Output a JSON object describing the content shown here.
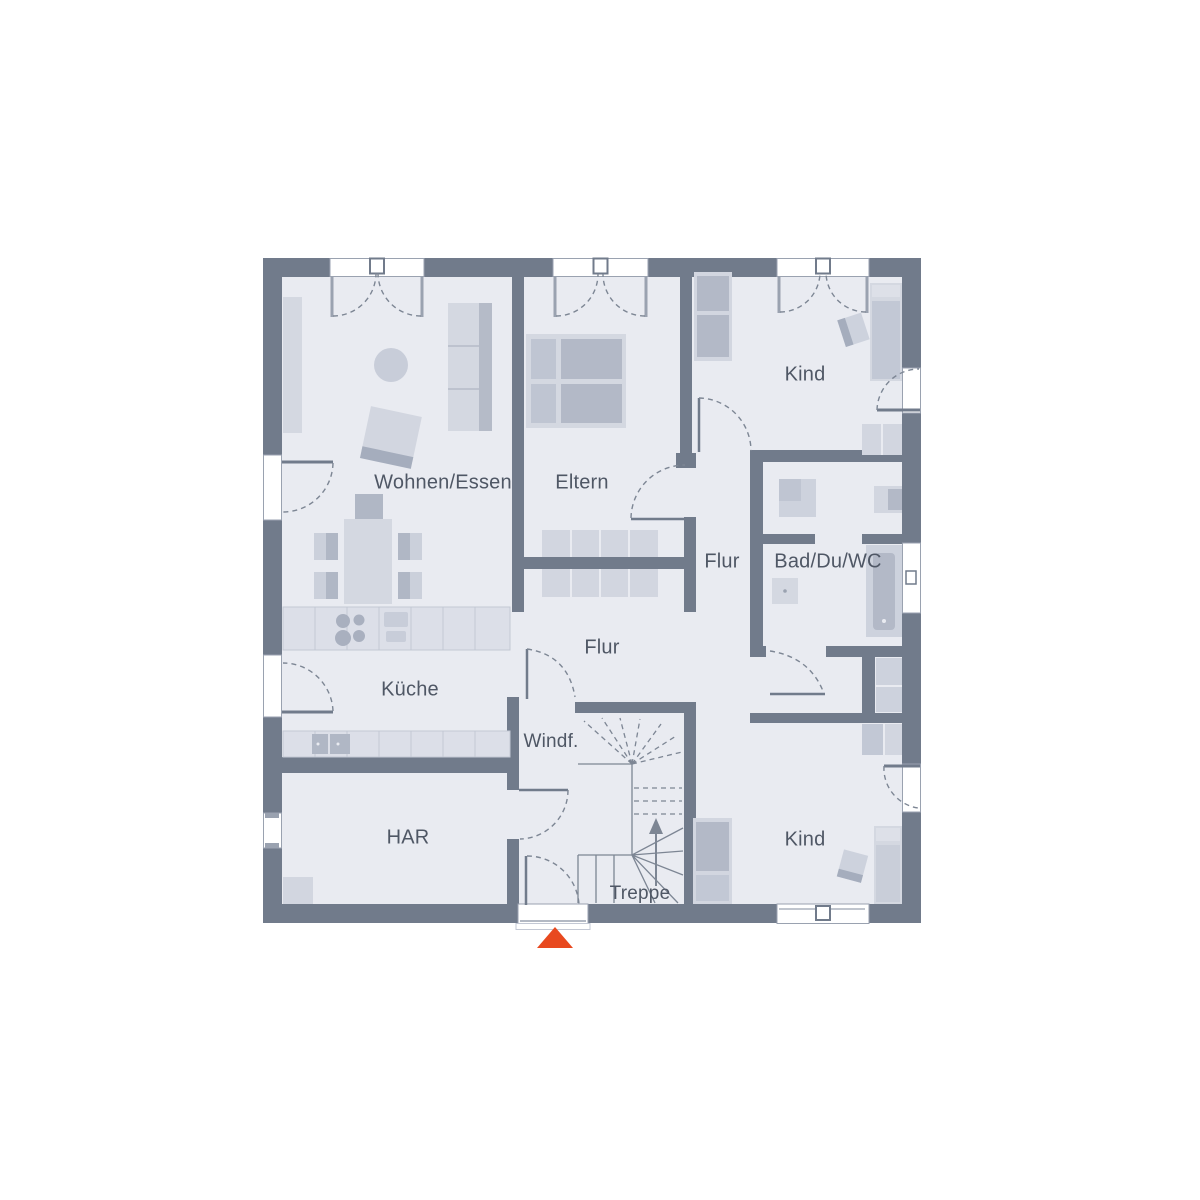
{
  "plan": {
    "title": "Grundriss",
    "rooms": {
      "wohnen_essen": "Wohnen/Essen",
      "eltern": "Eltern",
      "kind_top": "Kind",
      "flur_upper": "Flur",
      "bad": "Bad/Du/WC",
      "flur_main": "Flur",
      "kueche": "Küche",
      "windfang": "Windf.",
      "har": "HAR",
      "treppe": "Treppe",
      "kind_bottom": "Kind"
    },
    "palette": {
      "wall": "#717b8b",
      "floor": "#e9ebf1",
      "furniture_light": "#d4d8e1",
      "furniture_mid": "#c2c8d5",
      "furniture_dark": "#b0b7c5",
      "line": "#7d8694",
      "window_frame": "#9aa2b0",
      "entrance_arrow": "#e8491f",
      "label_text": "#4f5765",
      "background": "#ffffff"
    },
    "symbols": {
      "entrance_marker": "entrance-arrow",
      "stair_direction": "up-arrow"
    }
  }
}
